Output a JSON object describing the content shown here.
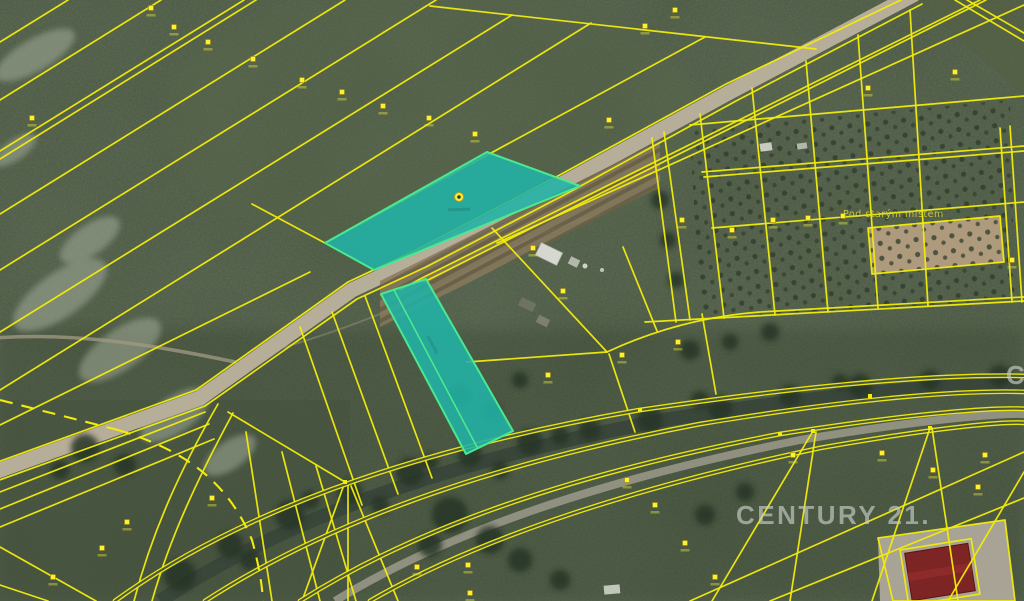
{
  "map": {
    "watermark": "CENTURY 21.",
    "watermark_partial": "C",
    "area_label": "Pod starým místem"
  },
  "colors": {
    "parcel_line": "#f2ec0b",
    "highlight_fill": "#21b3a6",
    "highlight_border": "#4ae98f",
    "road_surface": "#b7ae99",
    "river_water": "#39463a",
    "field_green": "#47543e",
    "watermark_gray": "#c8cec7",
    "building_red": "#7d2424"
  }
}
